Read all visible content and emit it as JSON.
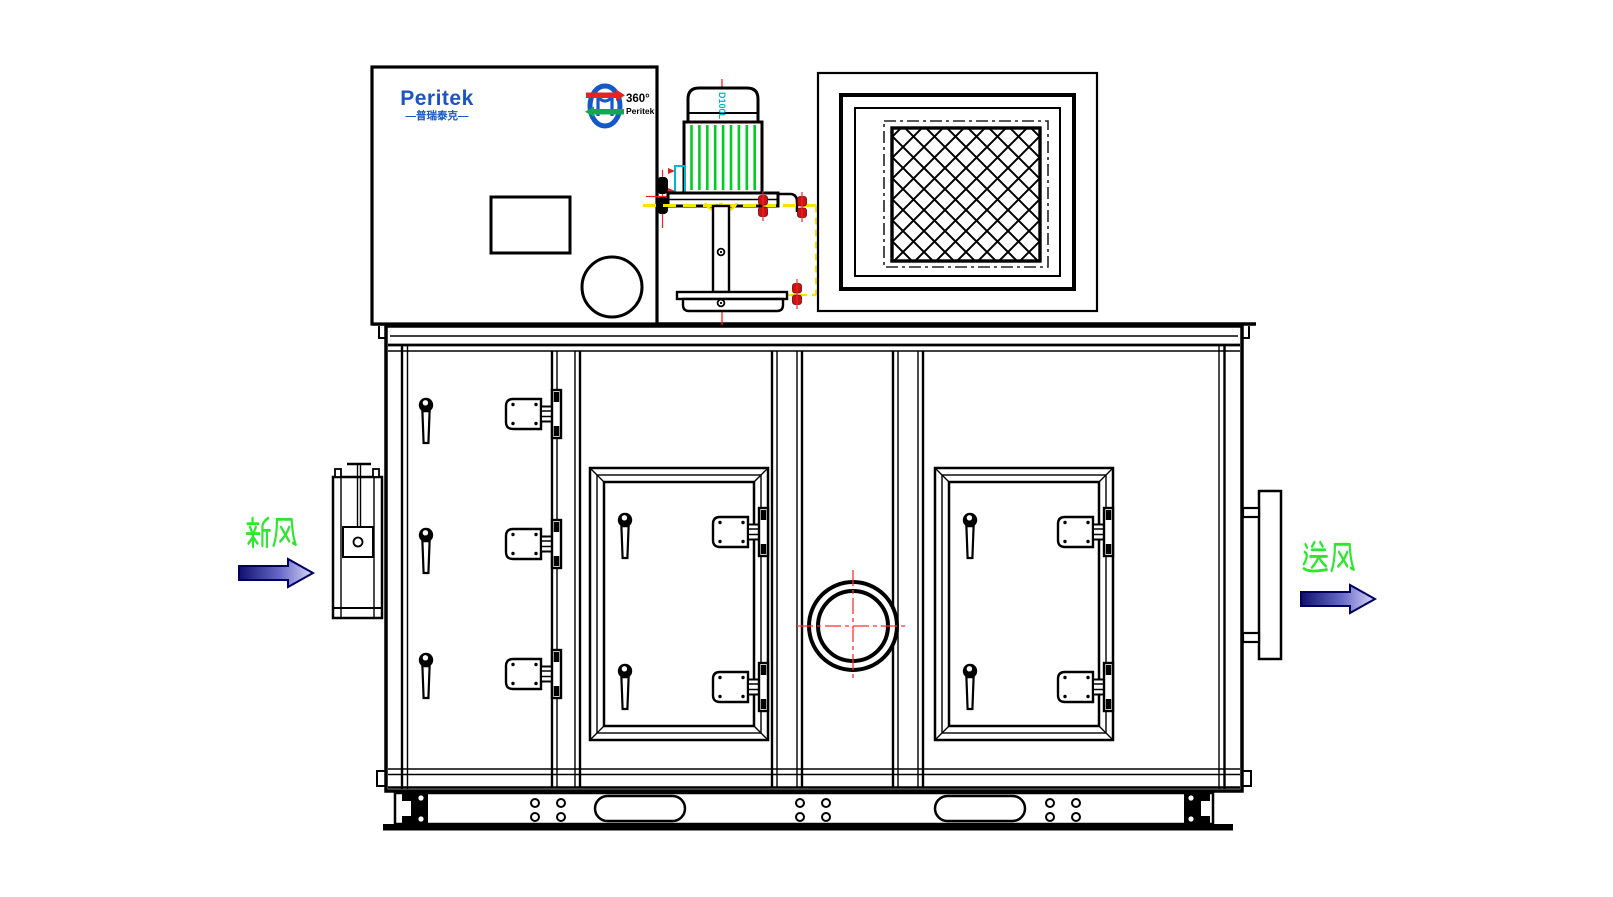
{
  "labels": {
    "fresh_air": "新风",
    "supply_air": "送风"
  },
  "branding": {
    "logo_text": "Peritek",
    "logo_subtext": "—普瑞泰克—",
    "badge_degree": "360°",
    "badge_brand": "Peritek",
    "motor_model": "D100L"
  },
  "colors": {
    "line_black": "#000000",
    "logo_blue": "#1b55c0",
    "fin_green": "#00cc22",
    "label_green": "#2ee62e",
    "centerline_red": "#ff2020",
    "bolt_red": "#c81414",
    "hidden_yellow": "#f5e400",
    "accent_cyan": "#00b8cc",
    "arrow_dark_blue": "#10106e",
    "arrow_light_blue": "#d8d8f8"
  }
}
